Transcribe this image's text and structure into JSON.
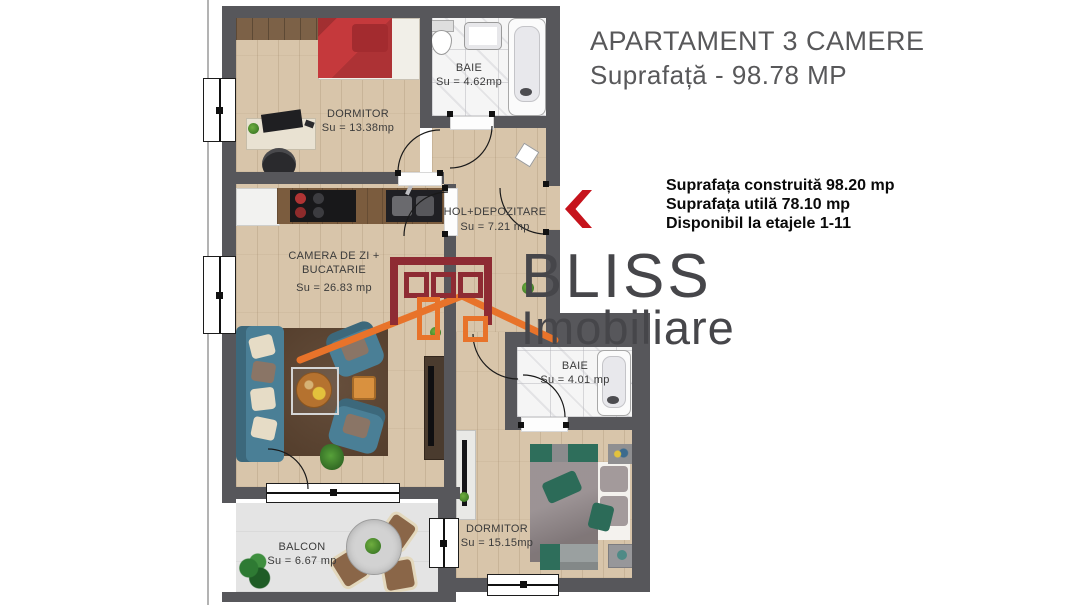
{
  "header": {
    "title": "APARTAMENT 3 CAMERE",
    "subtitle": "Suprafață - 98.78 MP"
  },
  "details": {
    "line1": "Suprafața construită 98.20 mp",
    "line2": "Suprafața utilă 78.10 mp",
    "line3": "Disponibil la etajele 1-11"
  },
  "watermark": {
    "brand": "BLISS",
    "brand2": "Imobiliare"
  },
  "rooms": {
    "dormitor1": {
      "name": "DORMITOR",
      "area": "Su = 13.38mp"
    },
    "baie1": {
      "name": "BAIE",
      "area": "Su = 4.62mp"
    },
    "hol": {
      "name": "HOL+DEPOZITARE",
      "area": "Su = 7.21 mp"
    },
    "living": {
      "line1": "CAMERA DE ZI +",
      "line2": "BUCATARIE",
      "area": "Su = 26.83 mp"
    },
    "baie2": {
      "name": "BAIE",
      "area": "Su = 4.01 mp"
    },
    "dormitor2": {
      "name": "DORMITOR",
      "area": "Su = 15.15mp"
    },
    "balcon": {
      "name": "BALCON",
      "area": "Su = 6.67 mp"
    }
  },
  "colors": {
    "wall": "#57575b",
    "wood": "#d8c5aa",
    "marble": "#f5f5f5",
    "accent-red": "#c6131c",
    "logo-red": "#8e2b33",
    "logo-orange": "#e8732a",
    "sofa-teal": "#4a7f96",
    "bed-red": "#c5393c",
    "pillow-teal": "#2c6b58"
  }
}
